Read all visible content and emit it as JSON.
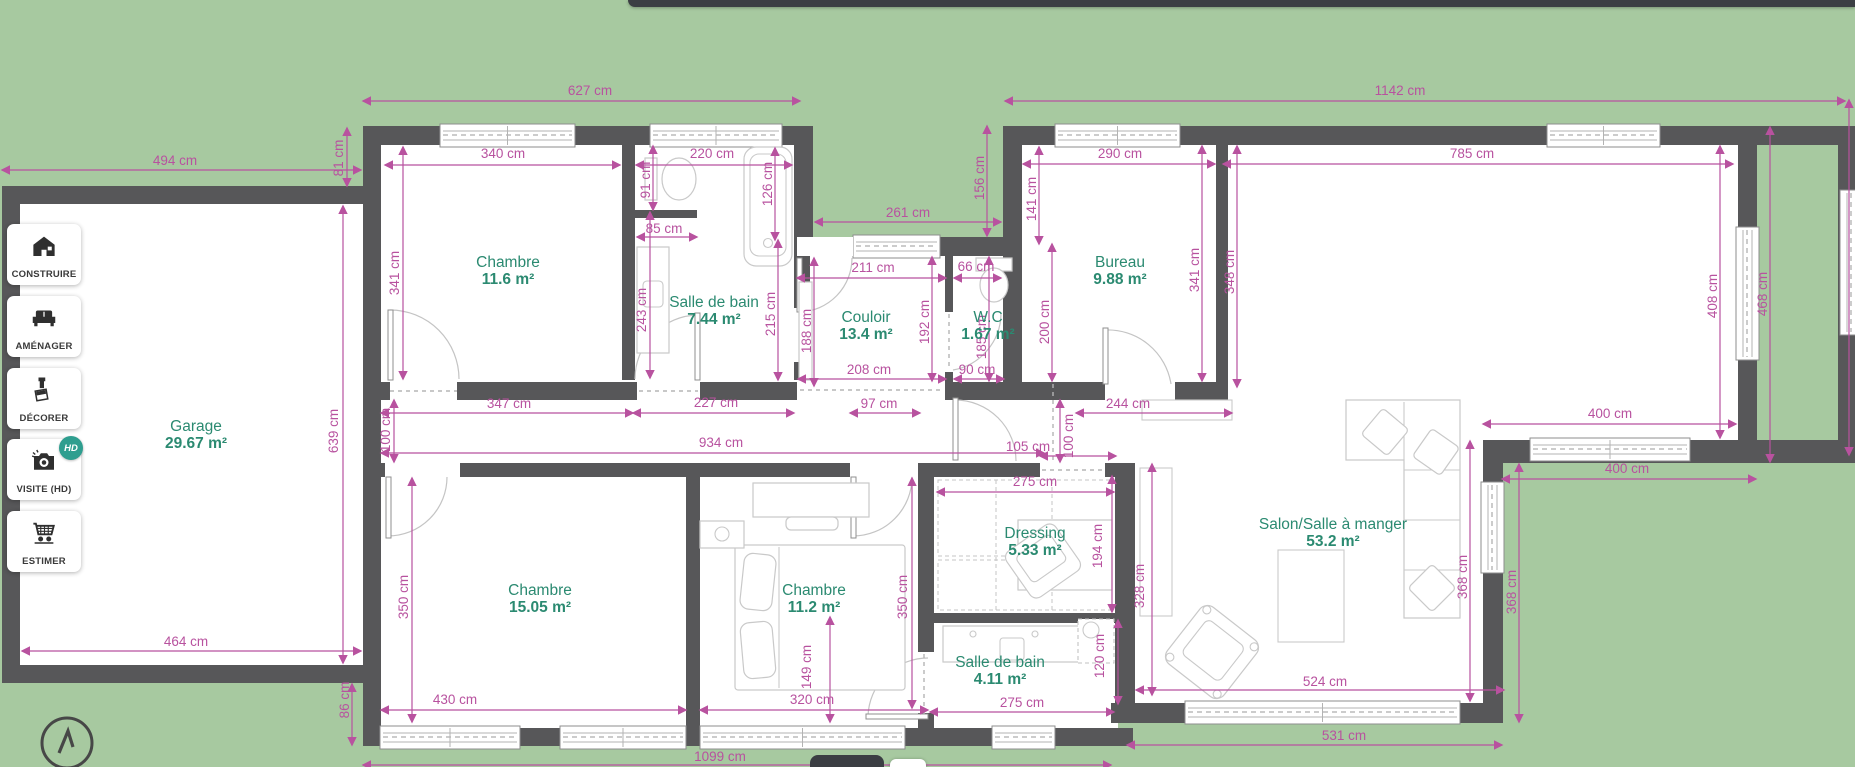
{
  "colors": {
    "background": "#a7c9a0",
    "wall": "#575759",
    "dimension": "#b8529f",
    "room_label": "#2b8a71",
    "hd_badge": "#2e9e8f"
  },
  "sidebar": {
    "buttons": [
      {
        "label": "CONSTRUIRE",
        "icon": "house-icon"
      },
      {
        "label": "AMÉNAGER",
        "icon": "sofa-icon"
      },
      {
        "label": "DÉCORER",
        "icon": "paint-roller-icon"
      },
      {
        "label": "VISITE (HD)",
        "icon": "camera-icon",
        "badge": "HD"
      },
      {
        "label": "ESTIMER",
        "icon": "cart-icon"
      }
    ]
  },
  "compass": {
    "icon": "north-arrow-icon"
  },
  "plan": {
    "unit": "cm",
    "rooms": [
      {
        "name": "Garage",
        "area": "29.67 m²",
        "x": 196,
        "y": 426,
        "slug": "garage"
      },
      {
        "name": "Chambre",
        "area": "11.6 m²",
        "x": 508,
        "y": 262,
        "slug": "chambre-1"
      },
      {
        "name": "Salle de bain",
        "area": "7.44 m²",
        "x": 714,
        "y": 302,
        "slug": "salle-de-bain-1"
      },
      {
        "name": "Couloir",
        "area": "13.4 m²",
        "x": 866,
        "y": 317,
        "slug": "couloir"
      },
      {
        "name": "W.C",
        "area": "1.67 m²",
        "x": 988,
        "y": 317,
        "slug": "wc"
      },
      {
        "name": "Bureau",
        "area": "9.88 m²",
        "x": 1120,
        "y": 262,
        "slug": "bureau"
      },
      {
        "name": "Chambre",
        "area": "15.05 m²",
        "x": 540,
        "y": 590,
        "slug": "chambre-2"
      },
      {
        "name": "Chambre",
        "area": "11.2 m²",
        "x": 814,
        "y": 590,
        "slug": "chambre-3"
      },
      {
        "name": "Dressing",
        "area": "5.33 m²",
        "x": 1035,
        "y": 533,
        "slug": "dressing"
      },
      {
        "name": "Salle de bain",
        "area": "4.11 m²",
        "x": 1000,
        "y": 662,
        "slug": "salle-de-bain-2"
      },
      {
        "name": "Salon/Salle à manger",
        "area": "53.2 m²",
        "x": 1333,
        "y": 524,
        "slug": "salon-salle-a-manger"
      }
    ],
    "dimensions": [
      {
        "t": "494 cm",
        "x": 175,
        "y": 160,
        "r": 0,
        "l": [
          2,
          170,
          361,
          170
        ]
      },
      {
        "t": "81 cm",
        "x": 338,
        "y": 158,
        "r": 1,
        "l": [
          347,
          128,
          347,
          186
        ]
      },
      {
        "t": "627 cm",
        "x": 590,
        "y": 90,
        "r": 0,
        "l": [
          363,
          101,
          800,
          101
        ]
      },
      {
        "t": "1142 cm",
        "x": 1400,
        "y": 90,
        "r": 0,
        "l": [
          1005,
          101,
          1845,
          101
        ]
      },
      {
        "t": "464 cm",
        "x": 186,
        "y": 641,
        "r": 0,
        "l": [
          22,
          651,
          361,
          651
        ]
      },
      {
        "t": "639 cm",
        "x": 333,
        "y": 431,
        "r": 1,
        "l": [
          343,
          206,
          343,
          663
        ]
      },
      {
        "t": "86 cm",
        "x": 344,
        "y": 700,
        "r": 1,
        "l": [
          352,
          684,
          352,
          745
        ]
      },
      {
        "t": "340 cm",
        "x": 503,
        "y": 153,
        "r": 0,
        "l": [
          385,
          165,
          620,
          165
        ]
      },
      {
        "t": "341 cm",
        "x": 394,
        "y": 273,
        "r": 1,
        "l": [
          403,
          147,
          403,
          379
        ]
      },
      {
        "t": "91 cm",
        "x": 645,
        "y": 180,
        "r": 1,
        "l": [
          653,
          146,
          653,
          210
        ]
      },
      {
        "t": "220 cm",
        "x": 712,
        "y": 153,
        "r": 0,
        "l": [
          636,
          165,
          792,
          165
        ]
      },
      {
        "t": "126 cm",
        "x": 767,
        "y": 184,
        "r": 1,
        "l": [
          775,
          148,
          775,
          240
        ]
      },
      {
        "t": "85 cm",
        "x": 664,
        "y": 228,
        "r": 0,
        "l": [
          637,
          237,
          697,
          237
        ]
      },
      {
        "t": "243 cm",
        "x": 641,
        "y": 310,
        "r": 1,
        "l": [
          650,
          212,
          650,
          378
        ]
      },
      {
        "t": "215 cm",
        "x": 770,
        "y": 314,
        "r": 1,
        "l": [
          778,
          240,
          778,
          380
        ]
      },
      {
        "t": "261 cm",
        "x": 908,
        "y": 212,
        "r": 0,
        "l": [
          815,
          222,
          1001,
          222
        ]
      },
      {
        "t": "156 cm",
        "x": 979,
        "y": 178,
        "r": 1,
        "l": [
          987,
          126,
          987,
          236
        ]
      },
      {
        "t": "211 cm",
        "x": 873,
        "y": 267,
        "r": 0,
        "l": [
          797,
          278,
          946,
          278
        ]
      },
      {
        "t": "66 cm",
        "x": 976,
        "y": 266,
        "r": 0,
        "l": [
          954,
          278,
          1001,
          278
        ]
      },
      {
        "t": "188 cm",
        "x": 806,
        "y": 331,
        "r": 1,
        "l": [
          814,
          258,
          814,
          386
        ]
      },
      {
        "t": "192 cm",
        "x": 924,
        "y": 322,
        "r": 1,
        "l": [
          932,
          257,
          932,
          381
        ]
      },
      {
        "t": "185 cm",
        "x": 981,
        "y": 337,
        "r": 1,
        "l": [
          989,
          257,
          989,
          381
        ]
      },
      {
        "t": "208 cm",
        "x": 869,
        "y": 369,
        "r": 0,
        "l": [
          798,
          379,
          946,
          379
        ]
      },
      {
        "t": "90 cm",
        "x": 977,
        "y": 369,
        "r": 0,
        "l": [
          954,
          379,
          1004,
          379
        ]
      },
      {
        "t": "290 cm",
        "x": 1120,
        "y": 153,
        "r": 0,
        "l": [
          1023,
          164,
          1215,
          164
        ]
      },
      {
        "t": "785 cm",
        "x": 1472,
        "y": 153,
        "r": 0,
        "l": [
          1223,
          164,
          1733,
          164
        ]
      },
      {
        "t": "141 cm",
        "x": 1031,
        "y": 199,
        "r": 1,
        "l": [
          1039,
          147,
          1039,
          244
        ]
      },
      {
        "t": "200 cm",
        "x": 1044,
        "y": 322,
        "r": 1,
        "l": [
          1052,
          244,
          1052,
          381
        ]
      },
      {
        "t": "341 cm",
        "x": 1194,
        "y": 270,
        "r": 1,
        "l": [
          1202,
          146,
          1202,
          381
        ]
      },
      {
        "t": "348 cm",
        "x": 1229,
        "y": 272,
        "r": 1,
        "l": [
          1237,
          146,
          1237,
          387
        ]
      },
      {
        "t": "408 cm",
        "x": 1712,
        "y": 296,
        "r": 1,
        "l": [
          1720,
          146,
          1720,
          438
        ]
      },
      {
        "t": "468 cm",
        "x": 1762,
        "y": 294,
        "r": 1,
        "l": [
          1770,
          127,
          1770,
          462
        ]
      },
      {
        "t": "",
        "x": 0,
        "y": 0,
        "r": 0,
        "l": [
          1849,
          100,
          1849,
          455
        ]
      },
      {
        "t": "400 cm",
        "x": 1610,
        "y": 413,
        "r": 0,
        "l": [
          1483,
          424,
          1736,
          424
        ]
      },
      {
        "t": "400 cm",
        "x": 1627,
        "y": 468,
        "r": 0,
        "l": [
          1502,
          479,
          1756,
          479
        ]
      },
      {
        "t": "368 cm",
        "x": 1462,
        "y": 577,
        "r": 1,
        "l": [
          1470,
          441,
          1470,
          701
        ]
      },
      {
        "t": "368 cm",
        "x": 1511,
        "y": 592,
        "r": 1,
        "l": [
          1519,
          464,
          1519,
          722
        ]
      },
      {
        "t": "524 cm",
        "x": 1325,
        "y": 681,
        "r": 0,
        "l": [
          1136,
          690,
          1504,
          690
        ]
      },
      {
        "t": "531 cm",
        "x": 1344,
        "y": 735,
        "r": 0,
        "l": [
          1127,
          745,
          1502,
          745
        ]
      },
      {
        "t": "347 cm",
        "x": 509,
        "y": 403,
        "r": 0,
        "l": [
          381,
          413,
          633,
          413
        ]
      },
      {
        "t": "227 cm",
        "x": 716,
        "y": 402,
        "r": 0,
        "l": [
          633,
          413,
          794,
          413
        ]
      },
      {
        "t": "934 cm",
        "x": 721,
        "y": 442,
        "r": 0,
        "l": [
          381,
          453,
          1044,
          453
        ]
      },
      {
        "t": "100 cm",
        "x": 385,
        "y": 430,
        "r": 1,
        "l": [
          394,
          400,
          394,
          462
        ]
      },
      {
        "t": "100 cm",
        "x": 1068,
        "y": 436,
        "r": 1,
        "l": [
          1060,
          400,
          1060,
          462
        ]
      },
      {
        "t": "97 cm",
        "x": 879,
        "y": 403,
        "r": 0,
        "l": [
          850,
          413,
          920,
          413
        ]
      },
      {
        "t": "244 cm",
        "x": 1128,
        "y": 403,
        "r": 0,
        "l": [
          1076,
          413,
          1232,
          413
        ]
      },
      {
        "t": "105 cm",
        "x": 1028,
        "y": 446,
        "r": 0,
        "l": [
          1040,
          456,
          1116,
          456
        ]
      },
      {
        "t": "430 cm",
        "x": 455,
        "y": 699,
        "r": 0,
        "l": [
          381,
          710,
          686,
          710
        ]
      },
      {
        "t": "320 cm",
        "x": 812,
        "y": 699,
        "r": 0,
        "l": [
          700,
          710,
          928,
          710
        ]
      },
      {
        "t": "350 cm",
        "x": 403,
        "y": 597,
        "r": 1,
        "l": [
          412,
          478,
          412,
          722
        ]
      },
      {
        "t": "350 cm",
        "x": 902,
        "y": 597,
        "r": 1,
        "l": [
          912,
          478,
          912,
          708
        ]
      },
      {
        "t": "149 cm",
        "x": 806,
        "y": 667,
        "r": 1,
        "l": [
          830,
          617,
          830,
          722
        ]
      },
      {
        "t": "275 cm",
        "x": 1035,
        "y": 481,
        "r": 0,
        "l": [
          937,
          492,
          1114,
          492
        ]
      },
      {
        "t": "194 cm",
        "x": 1097,
        "y": 546,
        "r": 1,
        "l": [
          1112,
          476,
          1112,
          612
        ]
      },
      {
        "t": "328 cm",
        "x": 1139,
        "y": 586,
        "r": 1,
        "l": [
          1152,
          464,
          1152,
          695
        ]
      },
      {
        "t": "120 cm",
        "x": 1099,
        "y": 656,
        "r": 1,
        "l": [
          1118,
          620,
          1118,
          704
        ]
      },
      {
        "t": "275 cm",
        "x": 1022,
        "y": 702,
        "r": 0,
        "l": [
          930,
          712,
          1114,
          712
        ]
      },
      {
        "t": "1099 cm",
        "x": 720,
        "y": 756,
        "r": 0,
        "l": [
          363,
          765,
          1111,
          765
        ]
      }
    ]
  }
}
